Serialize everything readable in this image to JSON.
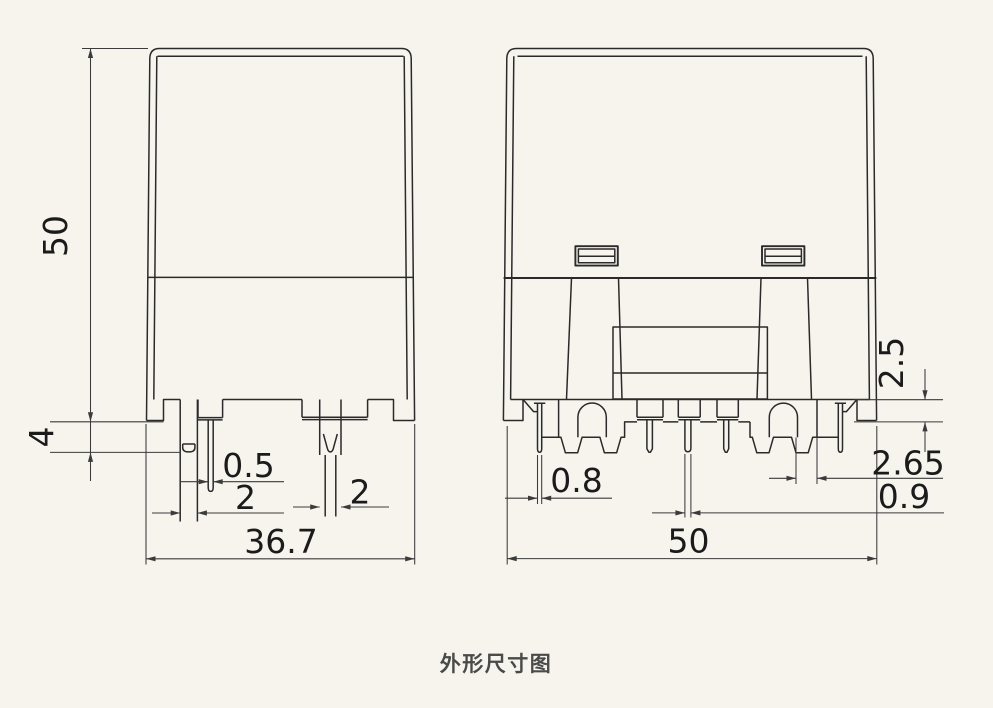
{
  "theme": {
    "background": "#f7f4ee",
    "line_color": "#2a2a2a",
    "dim_line_color": "#3b3b3b",
    "text_color": "#1b1b1b",
    "caption_color": "#4a4a4a"
  },
  "drawing": {
    "caption": "外形尺寸图",
    "side_view": {
      "dim_height": "50",
      "dim_standoff": "4",
      "dim_thin_pin": "0.5",
      "dim_left_pin": "2",
      "dim_right_pin": "2",
      "dim_width": "36.7"
    },
    "front_view": {
      "dim_base_height": "2.5",
      "dim_left_pin": "0.8",
      "dim_terminal": "2.65",
      "dim_center_pin": "0.9",
      "dim_width": "50"
    }
  }
}
